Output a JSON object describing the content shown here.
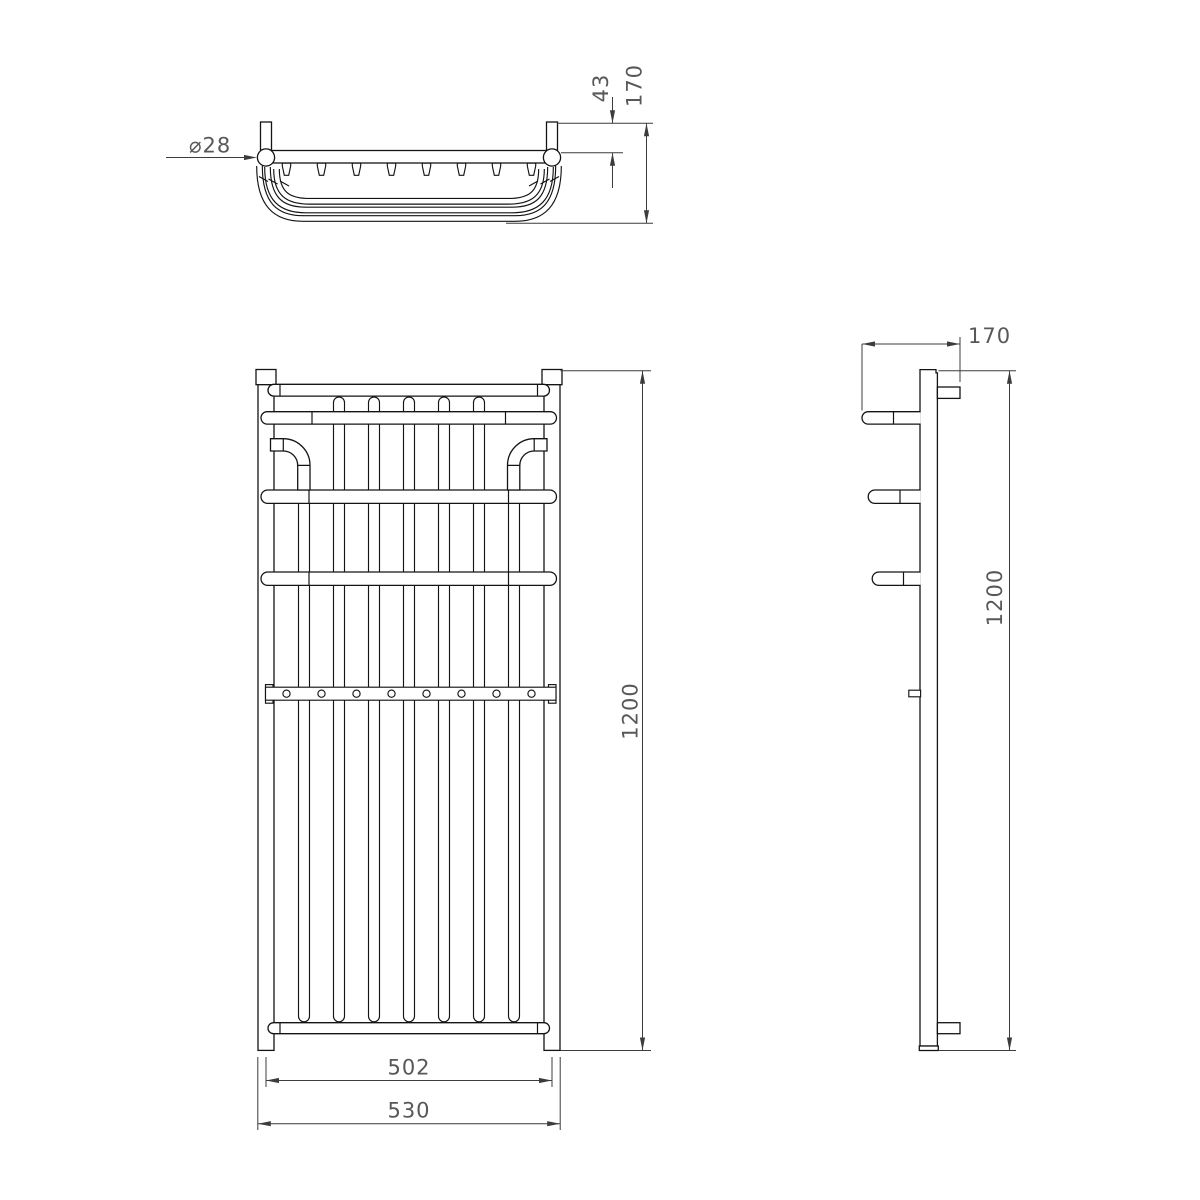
{
  "drawing": {
    "top_view": {
      "diameter": "⌀28",
      "wall_offset": "43",
      "depth": "170"
    },
    "front_view": {
      "height": "1200",
      "centres_width": "502",
      "overall_width": "530"
    },
    "side_view": {
      "depth": "170",
      "height": "1200"
    }
  },
  "colors": {
    "background": "#ffffff",
    "object_line": "#141414",
    "dimension_line": "#3c3c3c",
    "dimension_text": "#585858"
  }
}
